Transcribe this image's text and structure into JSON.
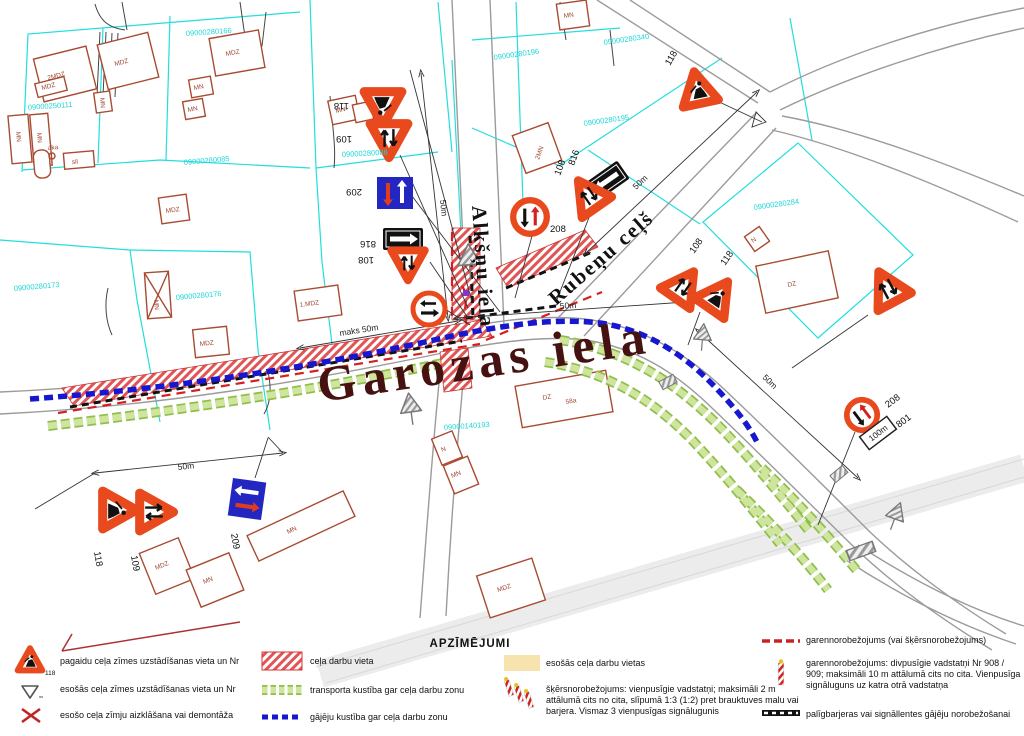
{
  "legend": {
    "title": "APZĪMĒJUMI",
    "col1": [
      {
        "label": "pagaidu ceļa zīmes uzstādīšanas vieta un Nr",
        "nr": "118"
      },
      {
        "label": "esošās ceļa zīmes uzstādīšanas vieta un Nr"
      },
      {
        "label": "esošo ceļa zīmju aizklāšana vai demontāža"
      }
    ],
    "col2": [
      {
        "label": "ceļa darbu vieta"
      },
      {
        "label": "transporta kustība gar ceļa darbu zonu"
      },
      {
        "label": "gājēju kustība gar ceļa darbu zonu"
      }
    ],
    "col3": [
      {
        "label": "esošās ceļa darbu vietas"
      },
      {
        "label": "šķērsnorobežojums: vienpusīgie vadstatņi; maksimāli 2 m attālumā cits no cita, slīpumā 1:3 (1:2) pret brauktuves malu vai barjera. Vismaz 3 vienpusīgas signālugunis"
      }
    ],
    "col4": [
      {
        "label": "garennorobežojums (vai šķērsnorobežojums)"
      },
      {
        "label": "garennorobežojums: divpusīgie vadstatņi Nr 908 / 909; maksimāli 10 m attālumā cits no cita. Vienpusīga signāluguns uz katra otrā vadstatņa"
      },
      {
        "label": "palīgbarjeras vai signāllentes gājēju norobežošanai"
      }
    ]
  },
  "map": {
    "street_main": "Garozas iela",
    "street_cross": "Alkšņu iela",
    "street_diag": "Rubeņu ceļš",
    "plate_100m": "100m",
    "parcels": [
      "09000250111",
      "09000280166",
      "09000280085",
      "09000280196",
      "09000280340",
      "09000280195",
      "09000280284",
      "09000280173",
      "09000280176",
      "09000280088",
      "09000140193"
    ],
    "buildings": [
      "2MDZ",
      "MDZ",
      "MDZ",
      "MDZ",
      "MN",
      "MN",
      "MN",
      "MN",
      "MN",
      "MN",
      "MDZ",
      "MN",
      "sil",
      "aka",
      "1.MDZ",
      "MDZ",
      "MN",
      "2MN",
      "N",
      "DZ",
      "N",
      "MN",
      "DZ",
      "58a",
      "MDZ",
      "MN",
      "MN",
      "MDZ"
    ],
    "dims": [
      "50m",
      "maks 50m",
      "50m",
      "50m",
      "50m",
      "50m"
    ],
    "sign_labels": [
      "118",
      "109",
      "209",
      "816",
      "108",
      "208",
      "108",
      "816",
      "118",
      "108",
      "118",
      "208",
      "801",
      "118",
      "109",
      "209"
    ],
    "colors": {
      "work_zone": "#e05555",
      "pedestrian": "#1717cf",
      "transport": "#8fbf4a",
      "sign_border": "#e8491d",
      "parcel": "#1fd6d6",
      "building": "#a84b32",
      "existing_zone": "#f7e3ae"
    }
  }
}
